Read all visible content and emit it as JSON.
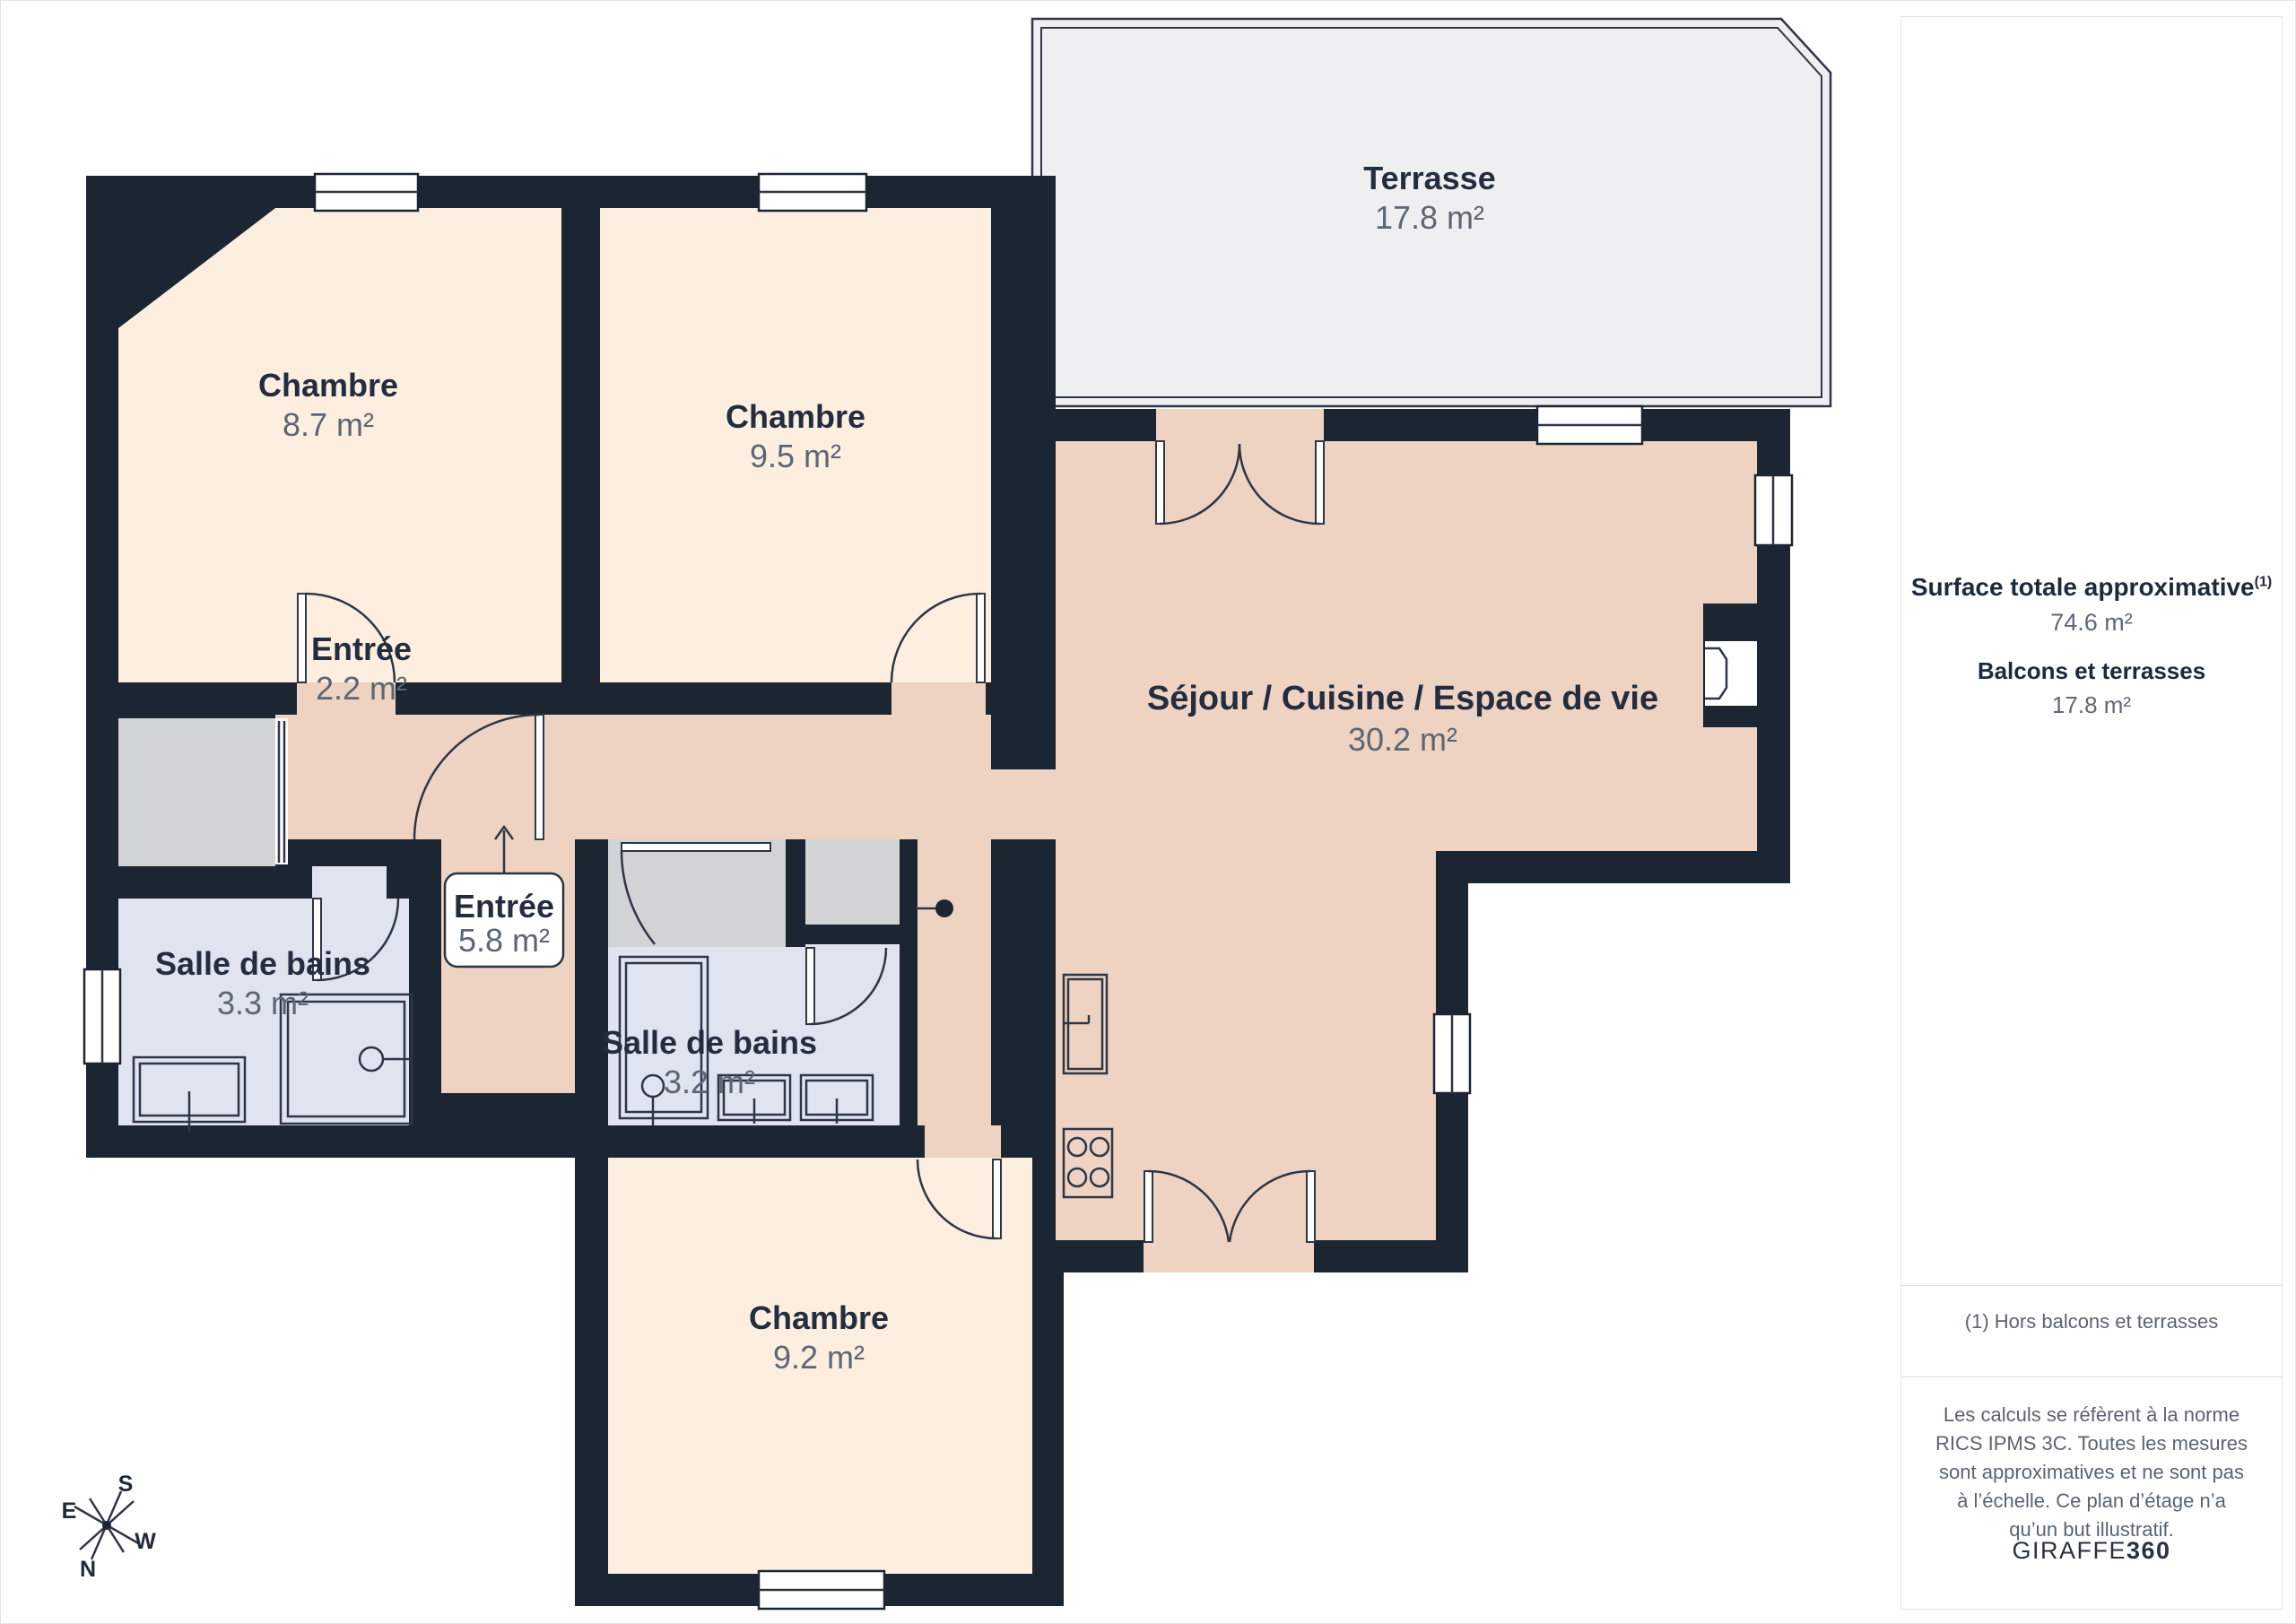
{
  "colors": {
    "wall": "#1c2532",
    "bedroom": "#fdefdf",
    "living": "#eed3c2",
    "bath": "#dfe4ef",
    "closet": "#d2d3d4",
    "terrace": "#efeff1",
    "line": "#2d3646"
  },
  "plan": {
    "rooms": [
      {
        "name": "Terrasse",
        "area": "17.8 m²"
      },
      {
        "name": "Chambre",
        "area": "8.7 m²"
      },
      {
        "name": "Chambre",
        "area": "9.5 m²"
      },
      {
        "name": "Séjour / Cuisine / Espace de vie",
        "area": "30.2 m²"
      },
      {
        "name": "Entrée",
        "area": "2.2 m²"
      },
      {
        "name": "Entrée",
        "area": "5.8 m²"
      },
      {
        "name": "Salle de bains",
        "area": "3.3 m²"
      },
      {
        "name": "Salle de bains",
        "area": "3.2 m²"
      },
      {
        "name": "Chambre",
        "area": "9.2 m²"
      }
    ],
    "compass": {
      "n": "N",
      "s": "S",
      "e": "E",
      "w": "W"
    }
  },
  "sidebar": {
    "title": "Surface totale approximative",
    "title_sup": "(1)",
    "total_value": "74.6 m²",
    "balconies_label": "Balcons et terrasses",
    "balconies_value": "17.8 m²",
    "footnote": "(1) Hors balcons et terrasses",
    "legal": "Les calculs se réfèrent à la norme RICS IPMS 3C. Toutes les mesures sont approximatives et ne sont pas à l’échelle. Ce plan d’étage n’a qu’un but illustratif.",
    "brand_regular": "GIRAFFE",
    "brand_bold": "360"
  }
}
